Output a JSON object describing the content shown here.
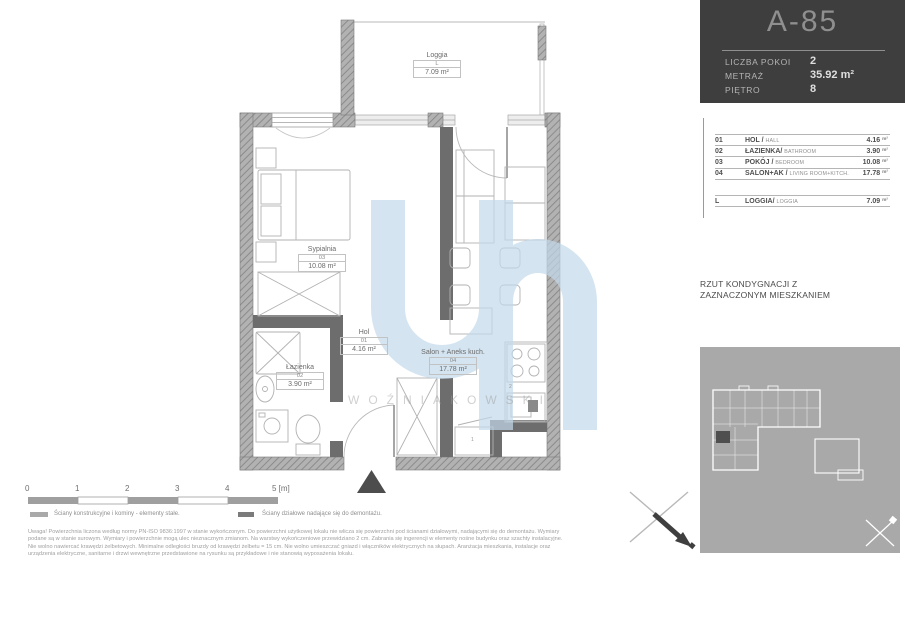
{
  "header": {
    "unit_id": "A-85",
    "rows": [
      {
        "label": "LICZBA POKOI",
        "value": "2"
      },
      {
        "label": "METRAŻ",
        "value": "35.92 m²"
      },
      {
        "label": "PIĘTRO",
        "value": "8"
      }
    ]
  },
  "room_table": {
    "unit": "m²",
    "rows": [
      {
        "no": "01",
        "name": "HOL /",
        "name_en": "HALL",
        "area": "4.16"
      },
      {
        "no": "02",
        "name": "ŁAZIENKA/",
        "name_en": "BATHROOM",
        "area": "3.90"
      },
      {
        "no": "03",
        "name": "POKÓJ /",
        "name_en": "BEDROOM",
        "area": "10.08"
      },
      {
        "no": "04",
        "name": "SALON+AK /",
        "name_en": "LIVING ROOM+KITCH.",
        "area": "17.78"
      }
    ],
    "loggia": {
      "no": "L",
      "name": "LOGGIA/",
      "name_en": "LOGGIA",
      "area": "7.09"
    }
  },
  "floor_note": {
    "line1": "RZUT KONDYGNACJI Z",
    "line2": "ZAZNACZONYM MIESZKANIEM"
  },
  "plan": {
    "rooms": [
      {
        "name": "Sypialnia",
        "no": "03",
        "area": "10.08 m²"
      },
      {
        "name": "Łazienka",
        "no": "02",
        "area": "3.90 m²"
      },
      {
        "name": "Hol",
        "no": "01",
        "area": "4.16 m²"
      },
      {
        "name": "Salon + Aneks kuch.",
        "no": "04",
        "area": "17.78 m²"
      },
      {
        "name": "Loggia",
        "no": "L",
        "area": "7.09 m²"
      }
    ],
    "marks": {
      "stove": "2",
      "cabinet": "1"
    }
  },
  "watermark": {
    "text": "WOŹNIAKOWSKI"
  },
  "scale_bar": {
    "ticks": [
      "0",
      "1",
      "2",
      "3",
      "4",
      "5 [m]"
    ]
  },
  "legend": [
    {
      "label": "Ściany konstrukcyjne i kominy - elementy stałe."
    },
    {
      "label": "Ściany działowe nadające się do demontażu."
    }
  ],
  "disclaimer": {
    "line1": "Uwaga! Powierzchnia liczona według normy PN-ISO 9836:1997 w stanie wykończonym. Do powierzchni użytkowej lokalu nie wlicza się powierzchni pod ścianami działowymi, nadającymi się do demontażu.  Wymiary",
    "line2": "podane są w stanie surowym. Wymiary i powierzchnie mogą ulec nieznacznym zmianom. Na warstwy wykończeniowe przewidziano 2 cm.  Zabrania się ingerencji w elementy nośne budynku oraz szachty instalacyjne.",
    "line3": "Nie wolno nawiercać krawędzi żelbetowych. Minimalne odległości bruzdy od krawędzi żelbetu = 15 cm. Nie wolno umieszczać gniazd i włączników elektrycznych na słupach. Aranżacja mieszkania, instalacje oraz",
    "line4": "urządzenia elektryczne, sanitarne i drzwi wewnętrzne przedstawione na rysunku są przykładowe i nie stanowią wyposażenia lokalu."
  },
  "colors": {
    "header_bg": "#3E3E3E",
    "panel_bg": "#A9A9A9",
    "watermark_blue": "#C3D9EA",
    "structural_wall": "#ADADAD",
    "partition_wall": "#6D6D6D"
  }
}
